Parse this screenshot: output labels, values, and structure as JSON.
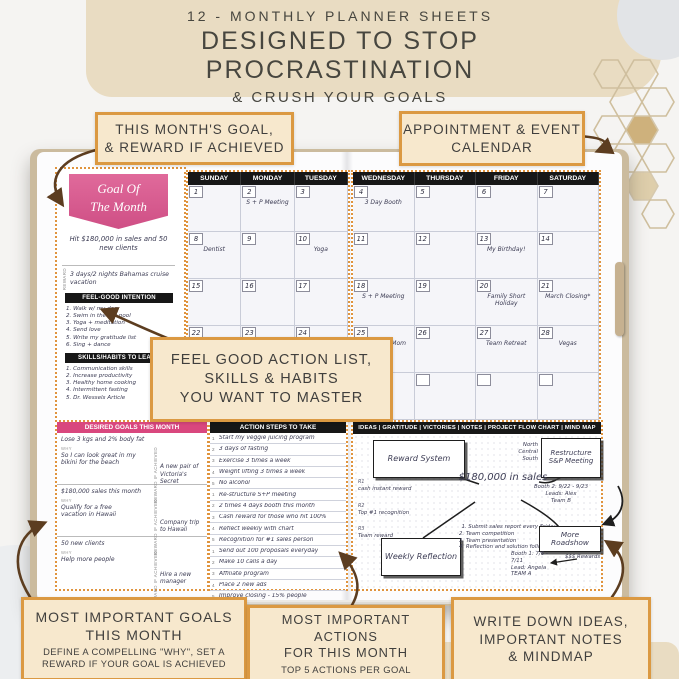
{
  "header": {
    "line1": "12 - MONTHLY PLANNER SHEETS",
    "line2": "DESIGNED TO STOP PROCRASTINATION",
    "line3": "& CRUSH YOUR GOALS"
  },
  "callouts": {
    "month_goal_line1": "THIS MONTH'S GOAL,",
    "month_goal_line2": "& REWARD IF ACHIEVED",
    "appointment_line1": "APPOINTMENT & EVENT",
    "appointment_line2": "CALENDAR",
    "feel_good_line1": "FEEL GOOD ACTION LIST,",
    "feel_good_line2": "SKILLS & HABITS",
    "feel_good_line3": "YOU WANT TO MASTER",
    "goals_title1": "MOST IMPORTANT GOALS",
    "goals_title2": "THIS MONTH",
    "goals_sub1": "DEFINE A COMPELLING \"WHY\", SET A",
    "goals_sub2": "REWARD IF YOUR GOAL IS ACHIEVED",
    "actions_title1": "MOST IMPORTANT ACTIONS",
    "actions_title2": "FOR THIS MONTH",
    "actions_sub": "TOP 5 ACTIONS PER GOAL",
    "ideas_line1": "WRITE DOWN IDEAS,",
    "ideas_line2": "IMPORTANT NOTES",
    "ideas_line3": "& MINDMAP"
  },
  "planner": {
    "goal_badge": {
      "title_line1": "Goal Of",
      "title_line2": "The Month",
      "goal_text": "Hit $180,000 in sales and 50 new clients",
      "reward_label": "REWARD",
      "reward_text": "3 days/2 nights Bahamas cruise vacation"
    },
    "feel_good": {
      "title": "FEEL-GOOD INTENTION",
      "items": [
        "1. Walk w/ my dog",
        "2. Swim in the hot pool",
        "3. Yoga + meditation",
        "4. Send love",
        "5. Write my gratitude list",
        "6. Sing + dance"
      ]
    },
    "skills": {
      "title": "SKILLS/HABITS TO LEARN",
      "items": [
        "1. Communication skills",
        "2. Increase productivity",
        "3. Healthy home cooking",
        "4. Intermittent fasting",
        "5. Dr. Wessels Article"
      ]
    },
    "calendar": {
      "left_headers": [
        "SUNDAY",
        "MONDAY",
        "TUESDAY"
      ],
      "right_headers": [
        "WEDNESDAY",
        "THURSDAY",
        "FRIDAY",
        "SATURDAY"
      ],
      "left_cells": [
        {
          "num": "1",
          "event": ""
        },
        {
          "num": "2",
          "event": "S + P Meeting"
        },
        {
          "num": "3",
          "event": ""
        },
        {
          "num": "8",
          "event": "Dentist"
        },
        {
          "num": "9",
          "event": ""
        },
        {
          "num": "10",
          "event": "Yoga"
        },
        {
          "num": "15",
          "event": ""
        },
        {
          "num": "16",
          "event": ""
        },
        {
          "num": "17",
          "event": ""
        },
        {
          "num": "22",
          "event": ""
        },
        {
          "num": "23",
          "event": ""
        },
        {
          "num": "24",
          "event": ""
        },
        {
          "num": "29",
          "event": ""
        },
        {
          "num": "30",
          "event": ""
        },
        {
          "num": "31",
          "event": ""
        }
      ],
      "right_cells": [
        {
          "num": "4",
          "event": "3 Day Booth"
        },
        {
          "num": "5",
          "event": ""
        },
        {
          "num": "6",
          "event": ""
        },
        {
          "num": "7",
          "event": ""
        },
        {
          "num": "11",
          "event": ""
        },
        {
          "num": "12",
          "event": ""
        },
        {
          "num": "13",
          "event": "My Birthday!"
        },
        {
          "num": "14",
          "event": ""
        },
        {
          "num": "18",
          "event": "S + P Meeting"
        },
        {
          "num": "19",
          "event": ""
        },
        {
          "num": "20",
          "event": "Family Short Holiday"
        },
        {
          "num": "21",
          "event": "March Closing*"
        },
        {
          "num": "25",
          "event": "Dinner w/ Mom"
        },
        {
          "num": "26",
          "event": ""
        },
        {
          "num": "27",
          "event": "Team Retreat"
        },
        {
          "num": "28",
          "event": "Vegas"
        },
        {
          "num": "",
          "event": ""
        },
        {
          "num": "",
          "event": ""
        },
        {
          "num": "",
          "event": ""
        },
        {
          "num": "",
          "event": ""
        }
      ]
    },
    "desired_goals": {
      "title": "DESIRED GOALS THIS MONTH",
      "why_label": "WHY",
      "reward_label": "REWARD IF ACHIEVED",
      "goals": [
        {
          "goal": "Lose 3 kgs and 2% body fat",
          "why": "So I can look great in my bikini for the beach",
          "reward": "A new pair of Victoria's Secret"
        },
        {
          "goal": "$180,000 sales this month",
          "why": "Qualify for a free vacation in Hawaii",
          "reward": "Company trip to Hawaii"
        },
        {
          "goal": "50 new clients",
          "why": "Help more people",
          "reward": "Hire a new manager"
        }
      ]
    },
    "action_steps": {
      "title": "ACTION STEPS TO TAKE",
      "items": [
        {
          "n": "1",
          "text": "Start my veggie juicing program"
        },
        {
          "n": "2",
          "text": "3 days of fasting"
        },
        {
          "n": "3",
          "text": "Exercise 3 times a week"
        },
        {
          "n": "4",
          "text": "Weight lifting 3 times a week"
        },
        {
          "n": "5",
          "text": "No alcohol"
        },
        {
          "n": "1",
          "text": "Re-structure S+P meeting"
        },
        {
          "n": "2",
          "text": "2 times 4 days booth this month"
        },
        {
          "n": "3",
          "text": "Cash reward for those who hit 100%"
        },
        {
          "n": "4",
          "text": "Reflect weekly with chart"
        },
        {
          "n": "5",
          "text": "Recognition for #1 sales person"
        },
        {
          "n": "1",
          "text": "Send out 100 proposals everyday"
        },
        {
          "n": "2",
          "text": "Make 10 calls a day"
        },
        {
          "n": "3",
          "text": "Affiliate program"
        },
        {
          "n": "4",
          "text": "Place 2 new ads"
        },
        {
          "n": "5",
          "text": "Improve closing - 15% people"
        }
      ]
    },
    "mindmap": {
      "title": "IDEAS  |  GRATITUDE  |  VICTORIES  |  NOTES  |  PROJECT FLOW CHART  |  MIND MAP",
      "center": "$180,000 in sales",
      "boxes": {
        "reward": "Reward System",
        "restructure": "Restructure S&P Meeting",
        "weekly": "Weekly Reflection",
        "roadshow": "More Roadshow"
      },
      "regions": [
        "North",
        "Central",
        "South"
      ],
      "r_notes": [
        {
          "label": "R1",
          "text": "cash instant reward"
        },
        {
          "label": "R2",
          "text": "Top #1 recognition"
        },
        {
          "label": "R3",
          "text": "Team reward"
        }
      ],
      "weekly_list": [
        "1. Submit sales report every Friday",
        "2. Team competition",
        "3. Team presentation",
        "4. Reflection and solution follow-up"
      ],
      "booth2": {
        "line1": "Booth 2: 9/22 - 9/23",
        "line2": "Leads: Alex",
        "line3": "Team B"
      },
      "booth1": {
        "line1": "Booth 1: 7/6 - 7/11",
        "line2": "Lead: Angela",
        "line3": "TEAM A"
      },
      "rewards_note": "$$$ Rewards"
    }
  },
  "colors": {
    "accent_orange": "#db9942",
    "accent_pink": "#d9477e",
    "beige": "#e9dcc2"
  }
}
